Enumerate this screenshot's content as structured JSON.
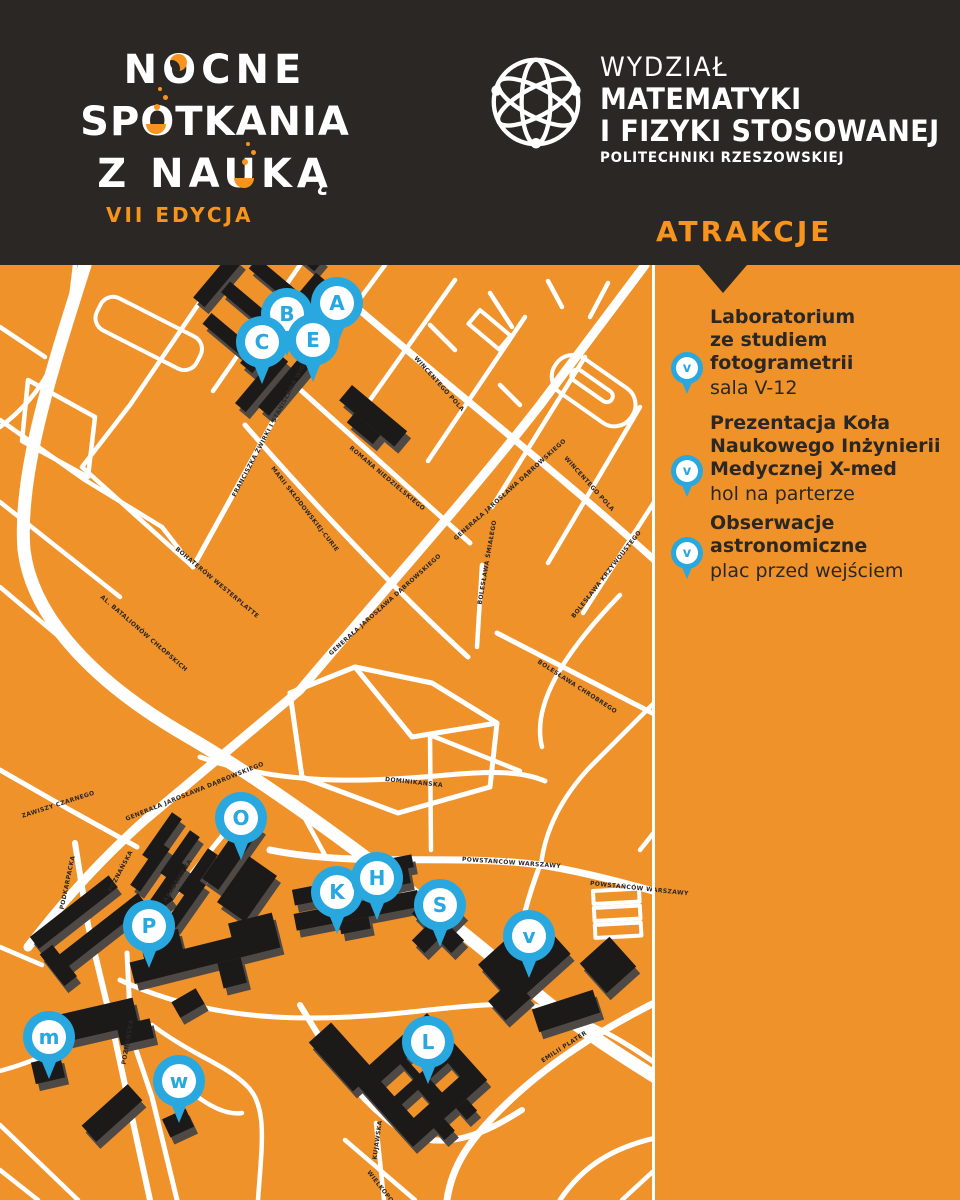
{
  "header": {
    "logo_left": {
      "line1": "NOCNE",
      "line2": "SPOTKANIA",
      "line3": "Z NAUKĄ",
      "edition": "VII EDYCJA"
    },
    "logo_right": {
      "line1": "WYDZIAŁ",
      "line2": "MATEMATYKI",
      "line3": "I FIZYKI STOSOWANEJ",
      "line4": "POLITECHNIKI RZESZOWSKIEJ"
    }
  },
  "sidebar": {
    "title": "ATRAKCJE",
    "items": [
      {
        "pin_letter": "v",
        "title": "Laboratorium\nze studiem\nfotogrametrii",
        "subtitle": "sala V-12"
      },
      {
        "pin_letter": "v",
        "title": "Prezentacja Koła\nNaukowego Inżynierii\nMedycznej X-med",
        "subtitle": "hol na parterze"
      },
      {
        "pin_letter": "v",
        "title": "Obserwacje\nastronomiczne",
        "subtitle": "plac przed wejściem"
      }
    ]
  },
  "map": {
    "markers": [
      {
        "letter": "A",
        "x": 337,
        "y": 303
      },
      {
        "letter": "B",
        "x": 287,
        "y": 314
      },
      {
        "letter": "C",
        "x": 262,
        "y": 342
      },
      {
        "letter": "E",
        "x": 313,
        "y": 340
      },
      {
        "letter": "O",
        "x": 241,
        "y": 818
      },
      {
        "letter": "P",
        "x": 149,
        "y": 926
      },
      {
        "letter": "K",
        "x": 337,
        "y": 892
      },
      {
        "letter": "H",
        "x": 377,
        "y": 878
      },
      {
        "letter": "S",
        "x": 440,
        "y": 905
      },
      {
        "letter": "v",
        "x": 529,
        "y": 936
      },
      {
        "letter": "m",
        "x": 49,
        "y": 1037
      },
      {
        "letter": "w",
        "x": 179,
        "y": 1081
      },
      {
        "letter": "L",
        "x": 428,
        "y": 1042
      }
    ],
    "street_labels": [
      {
        "text": "WINCENTEGO POLA",
        "x": 415,
        "y": 358,
        "angle": 48
      },
      {
        "text": "WINCENTEGO POLA",
        "x": 565,
        "y": 458,
        "angle": 48
      },
      {
        "text": "ROMANA NIEDZIELSKIEGO",
        "x": 350,
        "y": 448,
        "angle": 40
      },
      {
        "text": "MARII SKŁODOWSKIEJ-CURIE",
        "x": 272,
        "y": 468,
        "angle": 52
      },
      {
        "text": "FRANCISZKA ŻWIRKI I STANISŁAWA WIGURY",
        "x": 234,
        "y": 497,
        "angle": -62
      },
      {
        "text": "BOHATERÓW WESTERPLATTE",
        "x": 176,
        "y": 549,
        "angle": 40
      },
      {
        "text": "AL. BATALIONÓW CHŁOPSKICH",
        "x": 101,
        "y": 597,
        "angle": 41
      },
      {
        "text": "GENERAŁA JAROSŁAWA DĄBROWSKIEGO",
        "x": 455,
        "y": 540,
        "angle": -42
      },
      {
        "text": "GENERAŁA JAROSŁAWA DĄBROWSKIEGO",
        "x": 330,
        "y": 655,
        "angle": -42
      },
      {
        "text": "GENERAŁA JAROSŁAWA DĄBROWSKIEGO",
        "x": 126,
        "y": 820,
        "angle": -22
      },
      {
        "text": "ZAWISZY CZARNEGO",
        "x": 22,
        "y": 817,
        "angle": -18
      },
      {
        "text": "PODKARPACKA",
        "x": 62,
        "y": 910,
        "angle": -78
      },
      {
        "text": "POZNAŃSKA",
        "x": 110,
        "y": 892,
        "angle": -62
      },
      {
        "text": "AKADEMICKA",
        "x": 165,
        "y": 902,
        "angle": -58
      },
      {
        "text": "POWSTAŃCÓW WARSZAWY",
        "x": 462,
        "y": 860,
        "angle": 4
      },
      {
        "text": "POWSTAŃCÓW WARSZAWY",
        "x": 590,
        "y": 884,
        "angle": 6
      },
      {
        "text": "POZNAŃSKA",
        "x": 124,
        "y": 1065,
        "angle": -80
      },
      {
        "text": "KUJAWSKA",
        "x": 375,
        "y": 1160,
        "angle": -82
      },
      {
        "text": "WIELKOPOLSKA",
        "x": 368,
        "y": 1172,
        "angle": 52
      },
      {
        "text": "EMILII PLATER",
        "x": 542,
        "y": 1062,
        "angle": -33
      },
      {
        "text": "BOLESŁAWA KRZYWOUSTEGO",
        "x": 573,
        "y": 618,
        "angle": -52
      },
      {
        "text": "BOLESŁAWA ŚMIAŁEGO",
        "x": 480,
        "y": 605,
        "angle": -80
      },
      {
        "text": "BOLESŁAWA CHROBREGO",
        "x": 538,
        "y": 662,
        "angle": 33
      },
      {
        "text": "DOMINIKAŃSKA",
        "x": 385,
        "y": 780,
        "angle": 6
      }
    ]
  },
  "colors": {
    "background_orange": "#F0922A",
    "accent_orange": "#F7941D",
    "header_dark": "#2A2725",
    "marker_blue": "#29A8E0",
    "building_black": "#1C1A18",
    "road_white": "#FFFFFF"
  }
}
